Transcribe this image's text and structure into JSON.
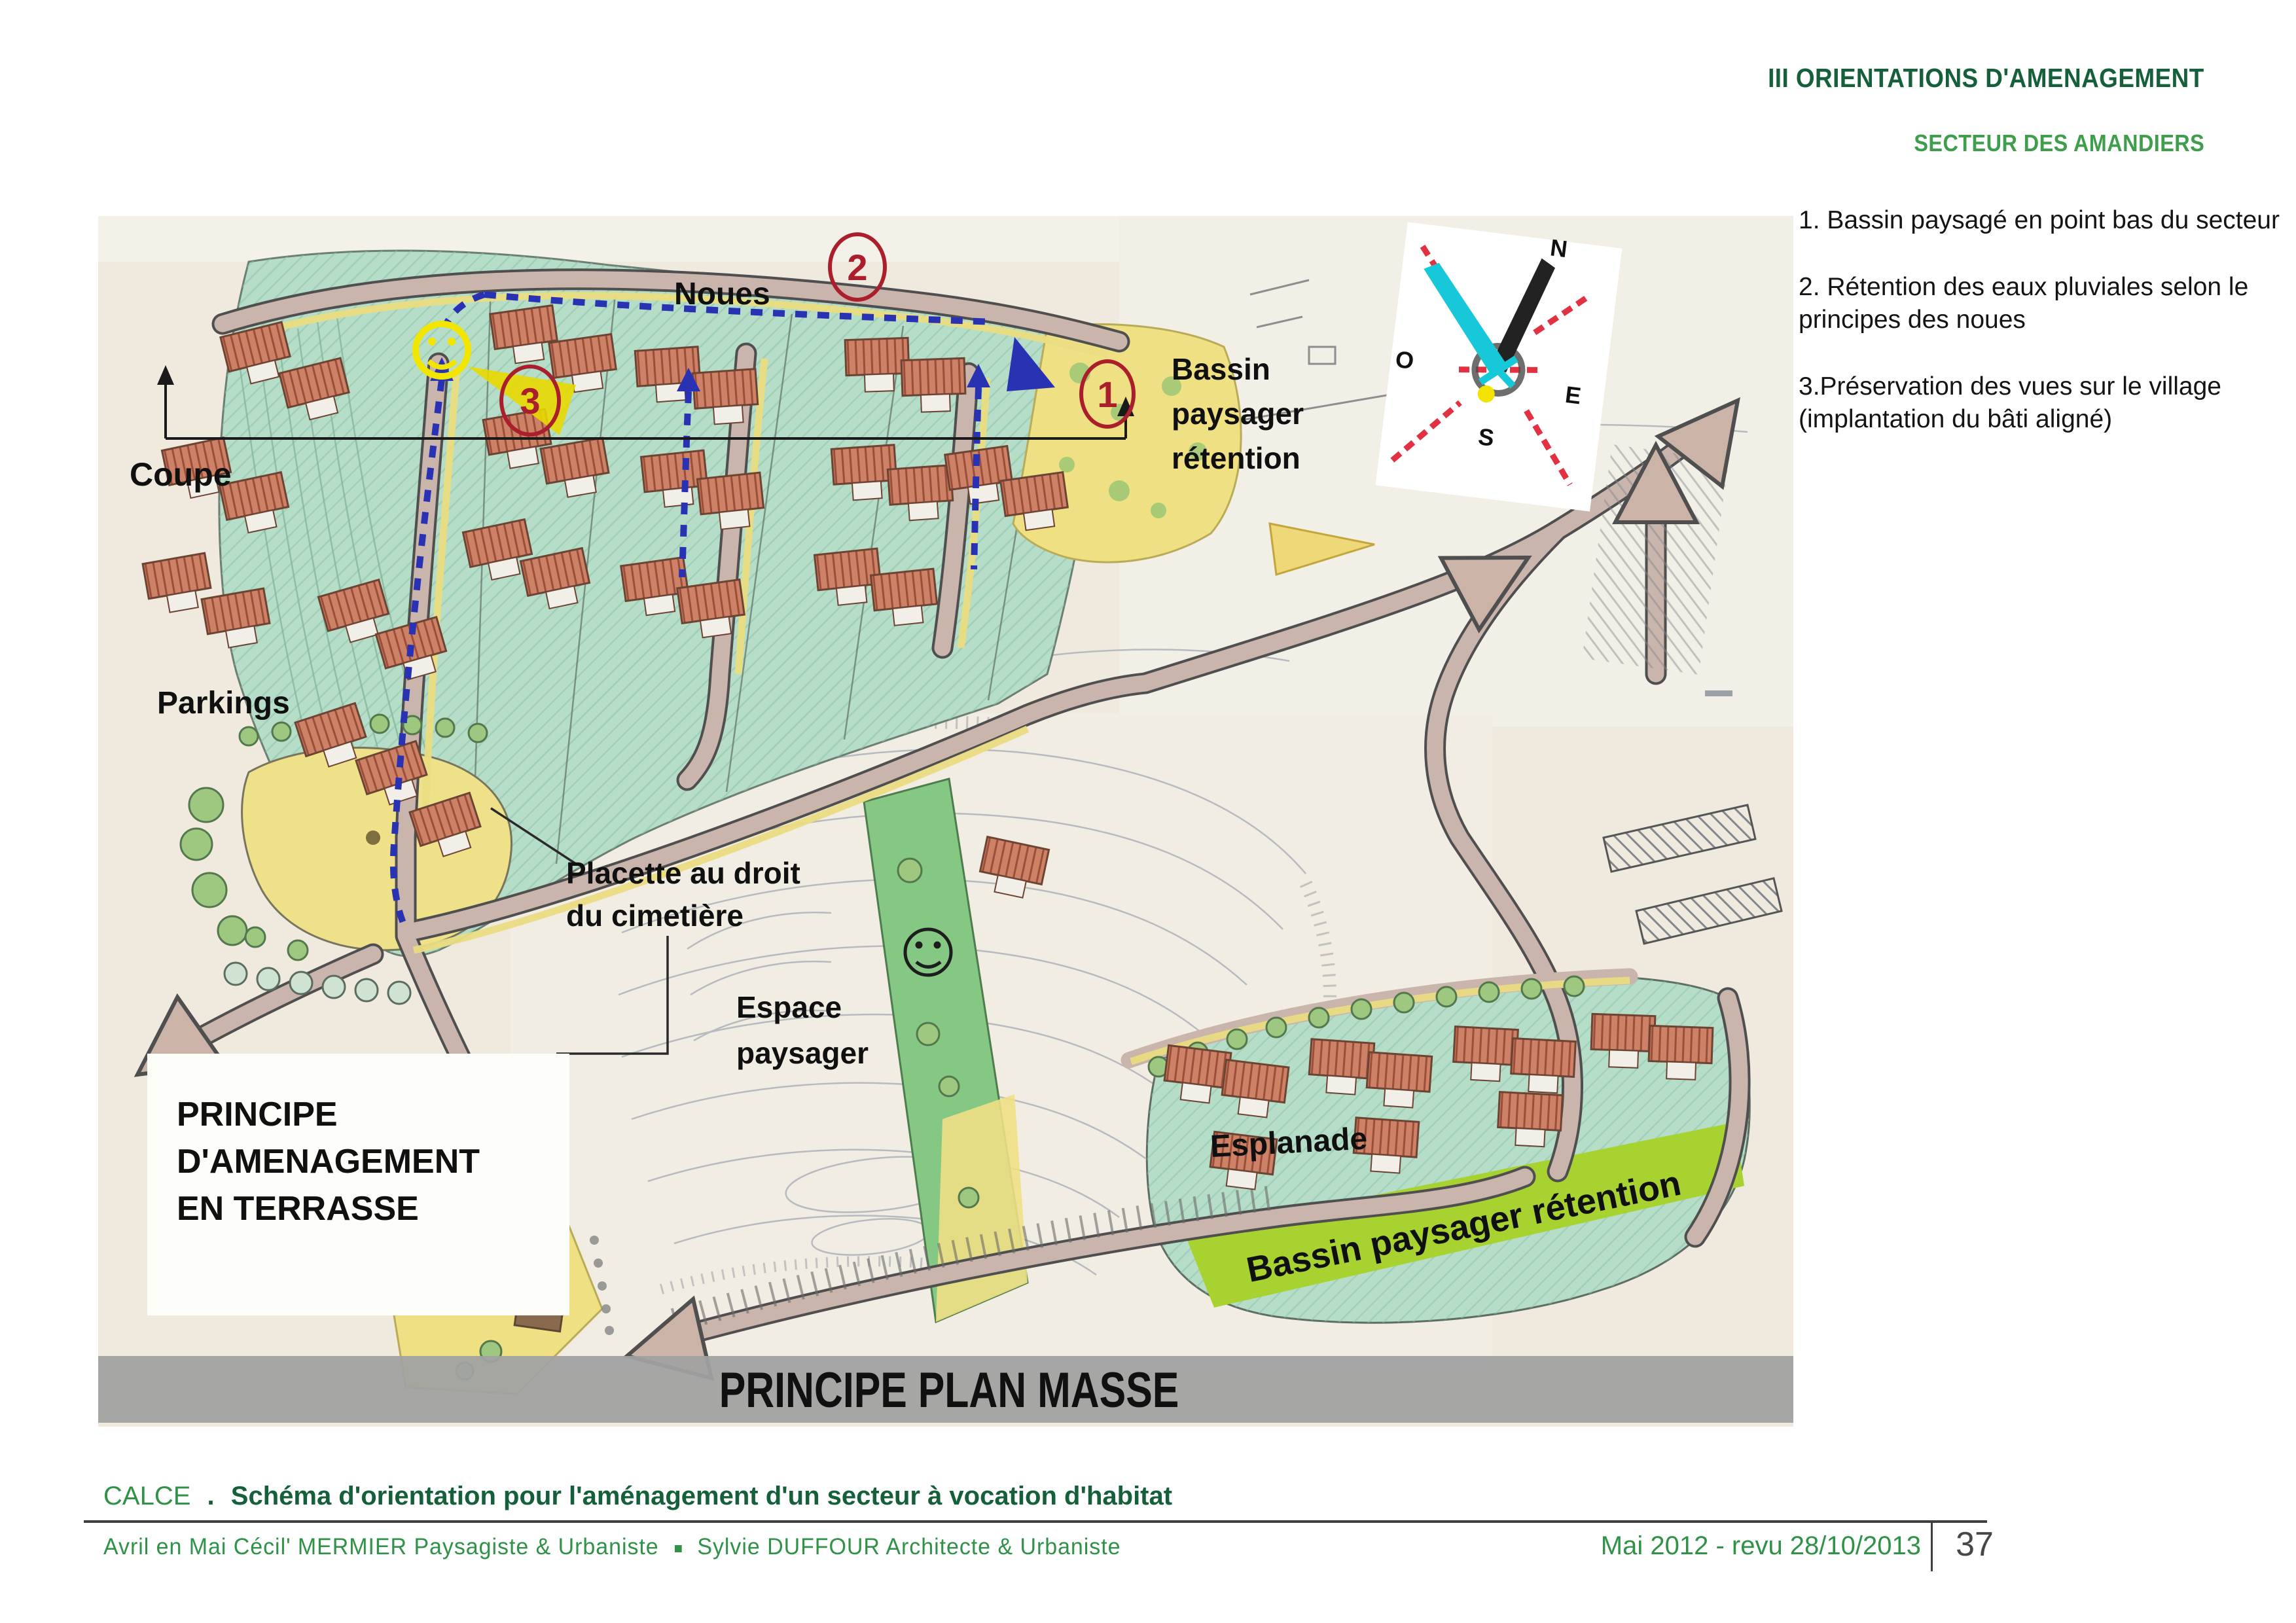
{
  "header": {
    "title": "III ORIENTATIONS D'AMENAGEMENT",
    "subtitle": "SECTEUR DES AMANDIERS"
  },
  "notes": {
    "items": [
      {
        "text": "1. Bassin paysagé en point bas du secteur"
      },
      {
        "text": "2. Rétention des eaux pluviales selon le principes des noues"
      },
      {
        "text": "3.Préservation des vues sur le village (implantation du bâti aligné)"
      }
    ]
  },
  "map": {
    "labels": {
      "noues": "Noues",
      "bassin1": "Bassin",
      "bassin2": "paysager",
      "bassin3": "rétention",
      "coupe": "Coupe",
      "parkings": "Parkings",
      "placette1": "Placette au droit",
      "placette2": "du cimetière",
      "espace1": "Espace",
      "espace2": "paysager",
      "esplanade": "Esplanade",
      "band": "Bassin paysager rétention",
      "box1": "PRINCIPE",
      "box2": "D'AMENAGEMENT",
      "box3": "EN TERRASSE",
      "banner": "PRINCIPE PLAN MASSE"
    },
    "markers": {
      "m1": "1",
      "m2": "2",
      "m3": "3"
    },
    "compass": {
      "n": "N",
      "o": "O",
      "e": "E",
      "s": "S"
    }
  },
  "caption": {
    "place": "CALCE",
    "sep": ".",
    "title": "Schéma d'orientation pour l'aménagement d'un secteur à vocation d'habitat"
  },
  "footer": {
    "author1": "Avril en Mai Cécil' MERMIER  Paysagiste & Urbaniste",
    "author2": "Sylvie DUFFOUR Architecte & Urbaniste",
    "date": "Mai 2012 - revu 28/10/2013",
    "page": "37"
  },
  "colors": {
    "accent_dark_green": "#15603a",
    "accent_green": "#3f9e4b",
    "annotation_red": "#ab1f2c",
    "noue_blue": "#2a32b4",
    "band_green": "#a7d22f"
  }
}
